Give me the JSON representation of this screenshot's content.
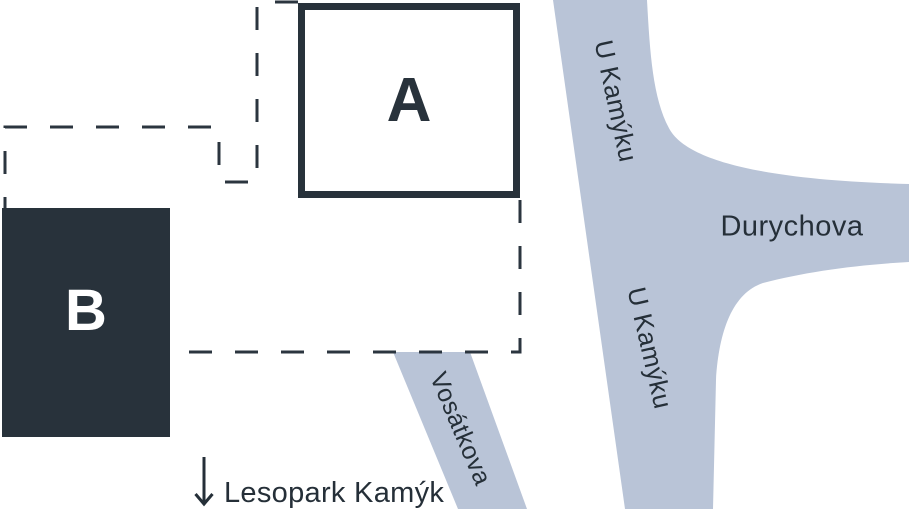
{
  "map": {
    "buildings": [
      {
        "label": "A",
        "style": "outlined"
      },
      {
        "label": "B",
        "style": "filled"
      }
    ],
    "streets": {
      "u_kamyku_upper": "U Kamýku",
      "u_kamyku_lower": "U Kamýku",
      "durychova": "Durychova",
      "vosatkova": "Vosátkova"
    },
    "poi": {
      "lesopark": "Lesopark Kamýk"
    },
    "colors": {
      "ink": "#28323b",
      "street": "#b9c4d7",
      "background": "#ffffff"
    }
  }
}
